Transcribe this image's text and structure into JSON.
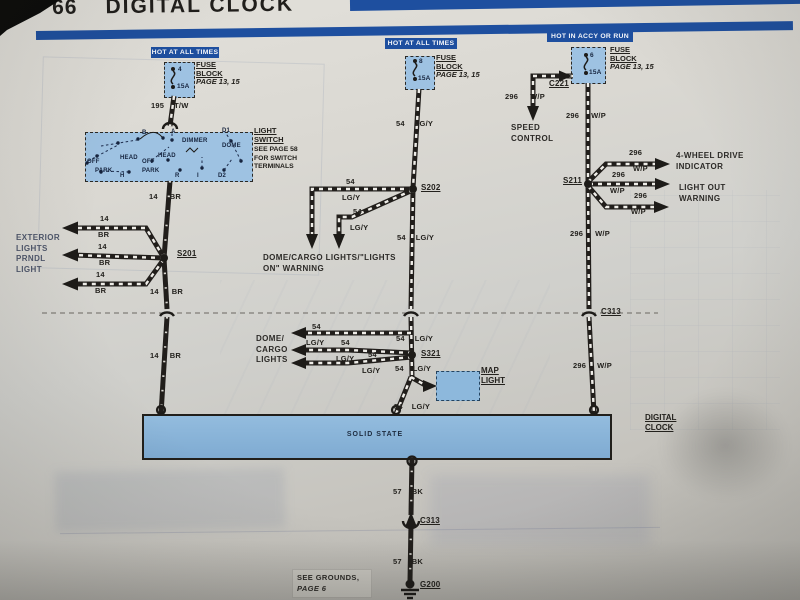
{
  "page": {
    "number": "66",
    "title": "DIGITAL CLOCK"
  },
  "colors": {
    "bar_blue": "#1e4f9f",
    "banner_blue": "#1e4f9f",
    "component_fill": "#9ec2e2",
    "clock_fill": "#85b0d6",
    "wire_black": "#211e1b"
  },
  "banners": {
    "b1": "HOT AT ALL TIMES",
    "b2": "HOT AT ALL TIMES",
    "b3": "HOT IN ACCY OR RUN"
  },
  "fuses": {
    "label": {
      "l1": "FUSE",
      "l2": "BLOCK",
      "l3": "PAGE 13, 15"
    },
    "f1": {
      "terminal": "4",
      "rating": "15A"
    },
    "f2": {
      "terminal": "8",
      "rating": "15A"
    },
    "f3": {
      "terminal": "6",
      "rating": "15A"
    }
  },
  "light_switch": {
    "label1": "LIGHT",
    "label2": "SWITCH",
    "note1": "SEE PAGE 58",
    "note2": "FOR SWITCH",
    "note3": "TERMINALS",
    "t_b": "B",
    "t_a": "A",
    "t_d1": "D1",
    "t_dimmer": "DIMMER",
    "t_dome": "DOME",
    "t_head1": "HEAD",
    "t_off1": "OFF",
    "t_park1": "PARK",
    "t_off2": "OFF",
    "t_head2": "HEAD",
    "t_park2": "PARK",
    "t_h": "H",
    "t_r": "R",
    "t_i": "I",
    "t_d2": "D2"
  },
  "wires": {
    "w195": {
      "num": "195",
      "color": "T/W"
    },
    "w14": {
      "num": "14",
      "color": "BR"
    },
    "w54": {
      "num": "54",
      "color": "LG/Y"
    },
    "w296": {
      "num": "296",
      "color": "W/P"
    },
    "w57": {
      "num": "57",
      "color": "BK"
    }
  },
  "splices": {
    "s201": "S201",
    "s202": "S202",
    "s211": "S211",
    "s321": "S321"
  },
  "connectors": {
    "c221": "C221",
    "c313": "C313",
    "g200": "G200"
  },
  "dest": {
    "exterior": [
      "EXTERIOR",
      "LIGHTS",
      "PRNDL",
      "LIGHT"
    ],
    "dome_warn": [
      "DOME/CARGO LIGHTS/\"LIGHTS",
      "ON\" WARNING"
    ],
    "speed": [
      "SPEED",
      "CONTROL"
    ],
    "fourwd": [
      "4-WHEEL DRIVE",
      "INDICATOR"
    ],
    "lightout": [
      "LIGHT OUT",
      "WARNING"
    ],
    "dome_cargo": [
      "DOME/",
      "CARGO",
      "LIGHTS"
    ],
    "map": [
      "MAP",
      "LIGHT"
    ],
    "clock": [
      "DIGITAL",
      "CLOCK"
    ],
    "solid_state": "SOLID STATE",
    "grounds": [
      "SEE GROUNDS,",
      "PAGE 6"
    ]
  }
}
